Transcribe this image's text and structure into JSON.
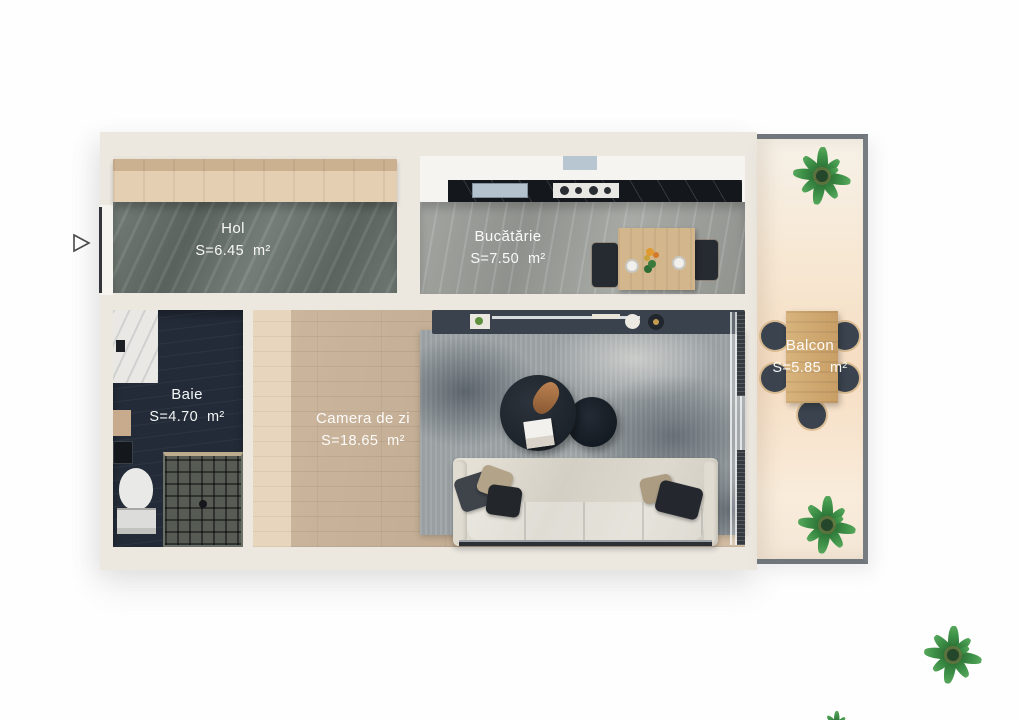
{
  "rooms": {
    "hol": {
      "name": "Hol",
      "area": "S=6.45  m²"
    },
    "bucatarie": {
      "name": "Bucătărie",
      "area": "S=7.50  m²"
    },
    "baie": {
      "name": "Baie",
      "area": "S=4.70  m²"
    },
    "camera_de_zi": {
      "name": "Camera de zi",
      "area": "S=18.65  m²"
    },
    "balcon": {
      "name": "Balcon",
      "area": "S=5.85  m²"
    }
  },
  "palette": {
    "wall": "#ece8e0",
    "hol_floor": "#6d7671",
    "kitchen_floor": "#9b9d99",
    "counter_marble": "#14181d",
    "bath_floor": "#222b37",
    "wood_floor": "#c7b29a",
    "rug": "#9fa5a8",
    "sofa": "#d5d1c6",
    "balcony_floor": "#f6e3cb",
    "table_wood": "#cfa76e",
    "plant_green": "#3e9148",
    "label_text": "#ffffff"
  }
}
